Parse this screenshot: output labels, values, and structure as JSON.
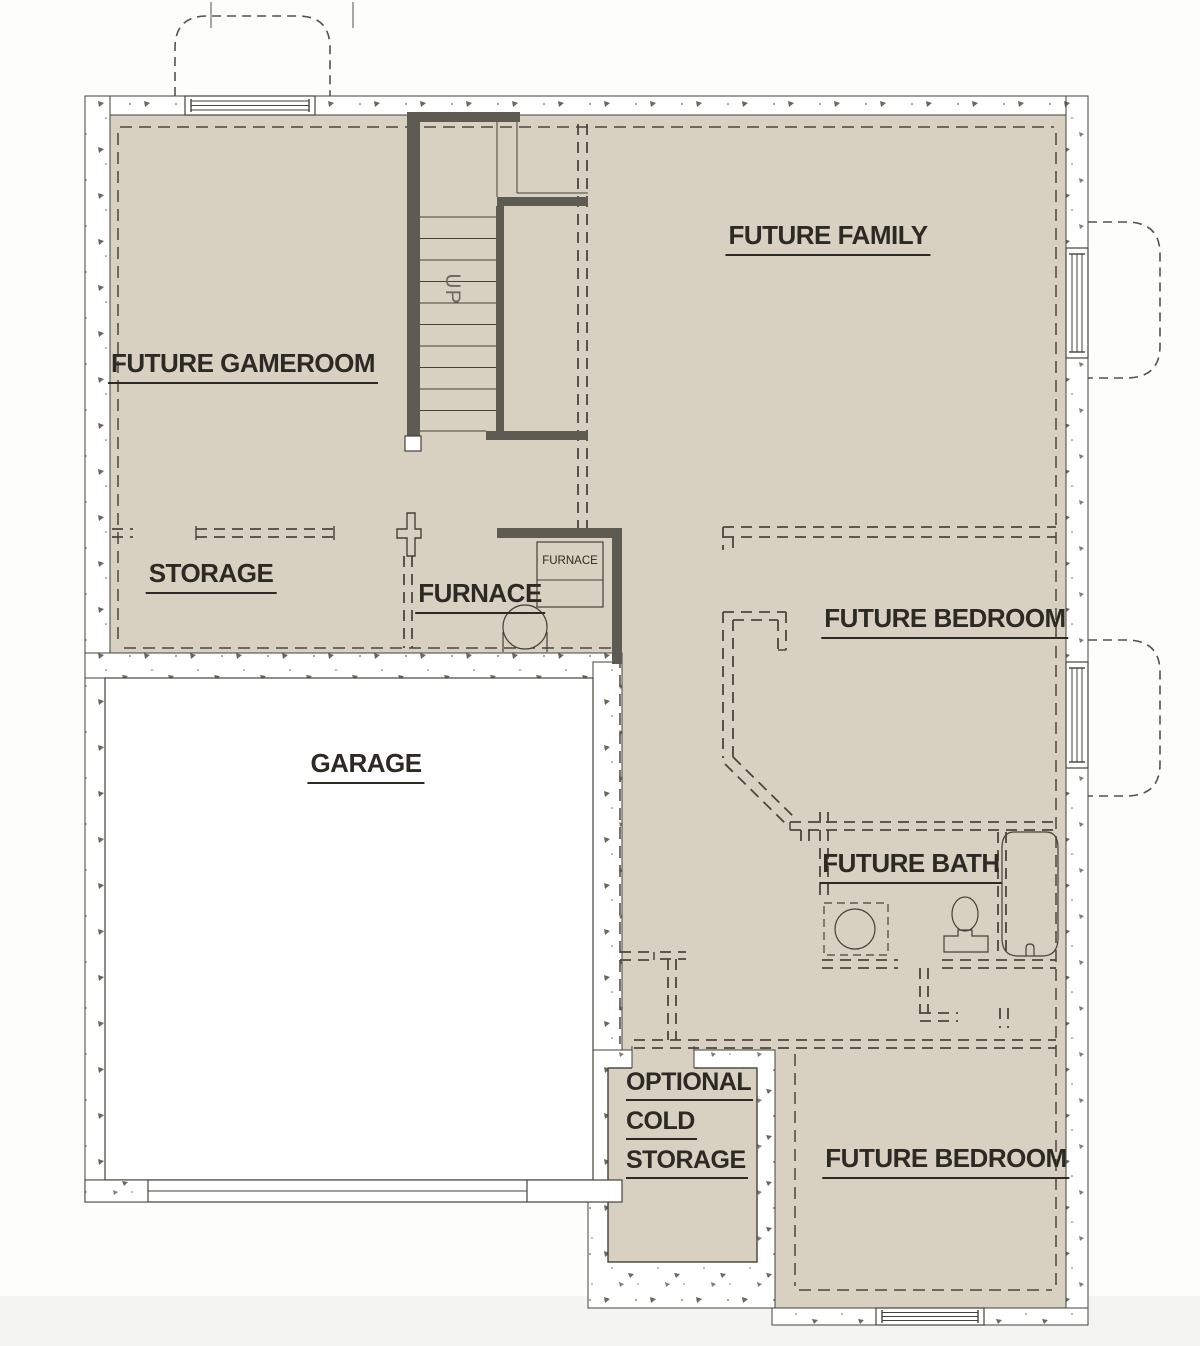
{
  "drawing": {
    "type": "basement-floor-plan",
    "palette": {
      "floor_fill": "#d8d0c0",
      "concrete_wall": "#ffffff",
      "framed_wall_dark": "#5e5b53",
      "line": "#44413a",
      "dashed_line": "#4a473f",
      "text": "#2d2a25",
      "muted_text": "#6e6a5d",
      "page_background": "#f6f6f4"
    },
    "rooms": {
      "gameroom": {
        "label": "FUTURE GAMEROOM"
      },
      "family": {
        "label": "FUTURE FAMILY"
      },
      "storage": {
        "label": "STORAGE"
      },
      "furnace_room": {
        "label": "FURNACE"
      },
      "garage": {
        "label": "GARAGE"
      },
      "bedroom_mid": {
        "label": "FUTURE BEDROOM"
      },
      "bath": {
        "label": "FUTURE BATH"
      },
      "cold_storage": {
        "lines": [
          "OPTIONAL",
          "COLD",
          "STORAGE"
        ]
      },
      "bedroom_lower": {
        "label": "FUTURE BEDROOM"
      }
    },
    "annotations": {
      "stair_direction": "UP",
      "furnace_unit": "FURNACE"
    }
  }
}
